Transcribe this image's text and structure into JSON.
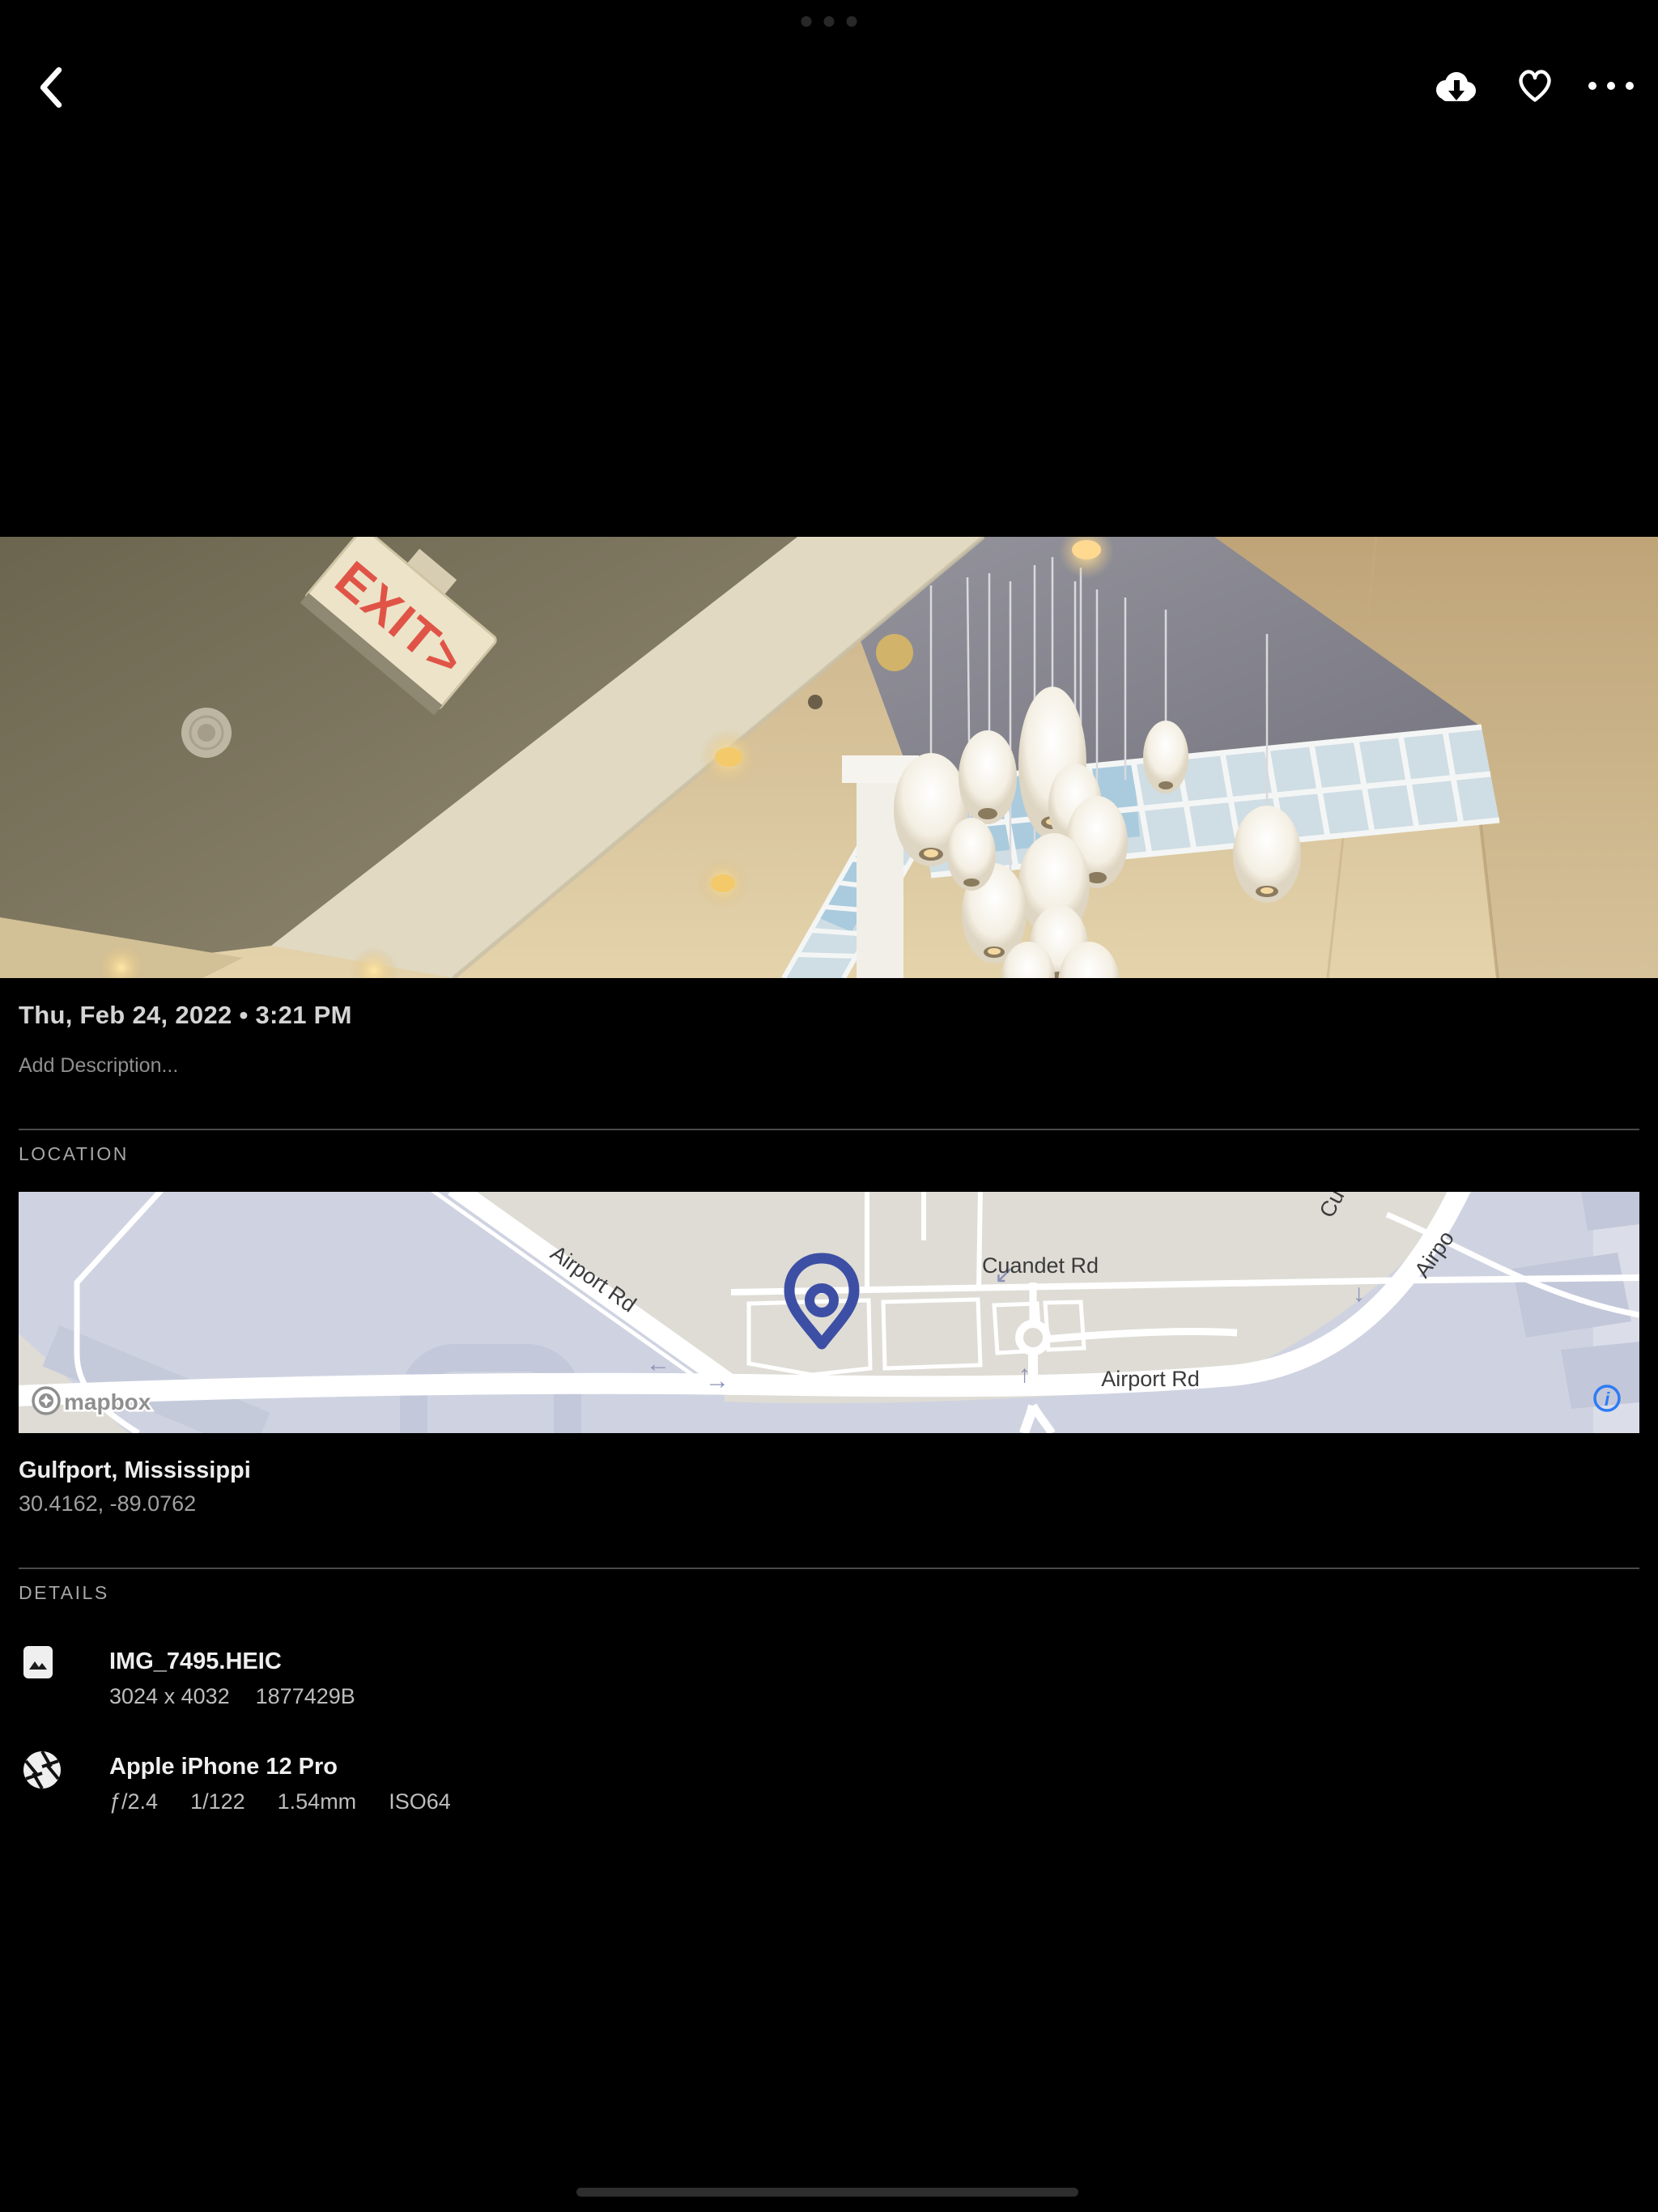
{
  "toolbar": {
    "back_icon": "chevron-left",
    "download_icon": "cloud-download",
    "favorite_icon": "heart-outline",
    "more_icon": "ellipsis"
  },
  "photo": {
    "exit_sign_text": "EXIT>",
    "datetime": "Thu, Feb 24, 2022 • 3:21 PM",
    "description_placeholder": "Add Description..."
  },
  "location": {
    "section_label": "LOCATION",
    "place": "Gulfport, Mississippi",
    "coordinates": "30.4162, -89.0762",
    "map": {
      "attribution": "mapbox",
      "info_icon": "i",
      "labels": {
        "airport_rd_diagonal": "Airport Rd",
        "airport_rd_horizontal": "Airport Rd",
        "cuandet_rd": "Cuandet Rd",
        "partial_road_top_1": "Cu",
        "partial_road_top_2": "Airpo"
      },
      "arrows": {
        "left": "←",
        "right": "→",
        "up": "↑",
        "down_left": "↙",
        "down": "↓"
      },
      "pin_color": "#3d4fa4",
      "info_color": "#2e7bf6"
    }
  },
  "details": {
    "section_label": "DETAILS",
    "file": {
      "name": "IMG_7495.HEIC",
      "dimensions": "3024 x 4032",
      "size": "1877429B"
    },
    "camera": {
      "model": "Apple iPhone 12 Pro",
      "aperture": "ƒ/2.4",
      "shutter": "1/122",
      "focal_length": "1.54mm",
      "iso": "ISO64"
    }
  }
}
